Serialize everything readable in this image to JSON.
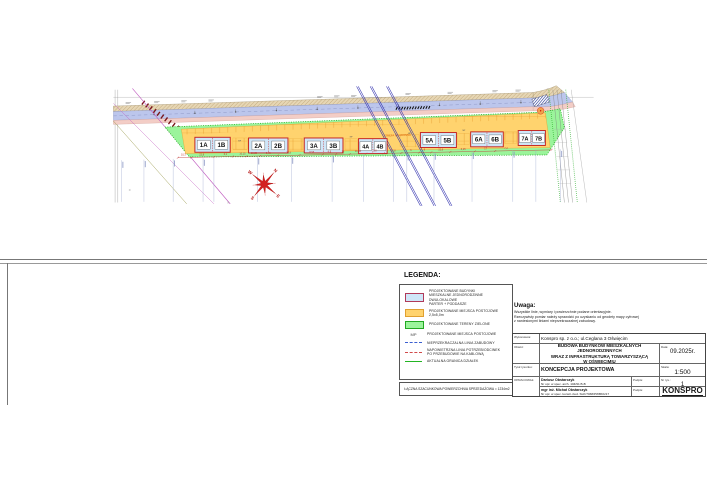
{
  "plan": {
    "buildings": [
      {
        "a": "1A",
        "b": "1B"
      },
      {
        "a": "2A",
        "b": "2B"
      },
      {
        "a": "3A",
        "b": "3B"
      },
      {
        "a": "4A",
        "b": "4B"
      },
      {
        "a": "5A",
        "b": "5B"
      },
      {
        "a": "6A",
        "b": "6B"
      },
      {
        "a": "7A",
        "b": "7B"
      }
    ],
    "dims": [
      "10,3",
      "22,8",
      "6,1",
      "10,15",
      "10,25",
      "9,45",
      "22,8",
      "8,58",
      "4,9",
      "17",
      "10,45",
      "9,8",
      "22,8",
      "6",
      "8",
      "22,8",
      "6,25",
      "17",
      "7,2"
    ],
    "strefa_label": "STREFA OCHRONNA",
    "mp_label": "MP",
    "compass": {
      "n": "N",
      "e": "E",
      "s": "S",
      "w": "W"
    },
    "colors": {
      "building_fill": "#cfe6f8",
      "building_border": "#c32222",
      "road": "#bcc6ec",
      "sidewalk": "#f3cdc6",
      "green_area": "#9bf49b",
      "plots": "#ffd36e",
      "dimension": "#c03333",
      "power_line": "#2f2fae"
    }
  },
  "legend": {
    "title": "LEGENDA:",
    "items": [
      {
        "label": "PROJEKTOWANE BUDYNKI\nMIESZKALNE JEDNORODZINNE DWULOKALOWE\nPARTER + PODDASZE"
      },
      {
        "label": "PROJEKTOWANE MIEJSCA POSTOJOWE 2,5x5,0m"
      },
      {
        "label": "PROJEKTOWANE TERENY ZIELONE"
      },
      {
        "mp": "MP",
        "label": "PROJEKTOWANE MIEJSCA POSTOJOWE"
      },
      {
        "label": "NIEPRZEKRACZALNA LINIA ZABUDOWY"
      },
      {
        "label": "NAPOWIETRZNA LINIA POTRZEB/ODCINEK\nPO PRZEBUDOWIE NA KABLOWĄ"
      },
      {
        "label": "AKTUALNA GRANICA DZIAŁEK"
      }
    ],
    "summary": "ŁĄCZNA SZACUNKOWA POWIERZCHNIA SPRZEDAŻOWA = 1234m2"
  },
  "note": {
    "title": "Uwaga:",
    "body": "Wszystkie linie, wymiary i powierzchnie podane orientacyjnie.\nRzeczywisty pomiar należy sprawdzić po uzyskaniu od geodety mapy cyfrowej\nz naniesionymi liniami nieprzekraczalnej zabudowy."
  },
  "titleblock": {
    "contractor_label": "Wykonawca:",
    "contractor": "Konspro sp. z o.o.; ul.Ceglana 3 Oświęcim",
    "object_label": "Obiekt:",
    "object": "BUDOWA BUDYNKÓW MIESZKALNYCH JEDNORODZINNYCH\nWRAZ Z INFRASTRUKTURĄ TOWARZYSZĄCĄ\nW OŚWIĘCIMIU",
    "date_label": "Data:",
    "date": "09.2025r.",
    "drawing_title_label": "Tytuł rysunku:",
    "drawing_title": "KONCEPCJA PROJEKTOWA",
    "scale_label": "Skala:",
    "scale": "1:500",
    "author_label": "OPRACOWAŁ:",
    "authors": [
      {
        "name": "Dariusz Obstarczyk",
        "cred": "Nr upr. w spec. arch. 104/91 B-B"
      },
      {
        "name": "mgr inż. Michał Obstarczyk",
        "cred": "Nr upr. w spec. konstr.-bud. SLK/7038/PWBKb/17"
      }
    ],
    "signature_label": "Podpis:",
    "drawing_no_label": "Nr rys.:",
    "drawing_no": "1",
    "logo_top": "FIRMA PROJEKTOWA",
    "logo": "KONSPRO",
    "logo_sub": "www.konspro.pl"
  }
}
